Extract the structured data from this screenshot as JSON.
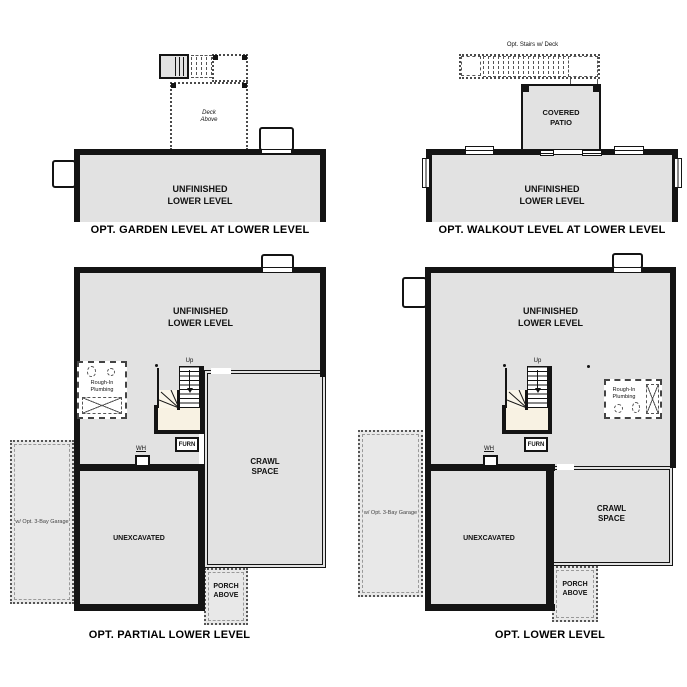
{
  "colors": {
    "wall": "#141414",
    "room_fill": "#e2e2e2",
    "optional_fill": "#e8e8e8",
    "landing_fill": "#f8f2e3",
    "dash_line": "#555555"
  },
  "labels": {
    "unfinished_lower_level": "UNFINISHED\nLOWER LEVEL",
    "covered_patio": "COVERED\nPATIO",
    "deck_above": "Deck\nAbove",
    "opt_stairs_w_deck": "Opt. Stairs w/ Deck",
    "crawl_space": "CRAWL\nSPACE",
    "unexcavated": "UNEXCAVATED",
    "rough_in_plumbing": "Rough-In\nPlumbing",
    "porch_above": "PORCH\nABOVE",
    "opt_garage": "w/ Opt. 3-Bay Garage",
    "furnace": "FURN",
    "water_heater": "WH",
    "up": "Up"
  },
  "plans": {
    "garden_level": {
      "caption": "OPT. GARDEN LEVEL AT LOWER LEVEL"
    },
    "walkout_level": {
      "caption": "OPT. WALKOUT LEVEL AT LOWER LEVEL"
    },
    "partial_lower": {
      "caption": "OPT. PARTIAL LOWER LEVEL"
    },
    "lower_level": {
      "caption": "OPT. LOWER LEVEL"
    }
  }
}
